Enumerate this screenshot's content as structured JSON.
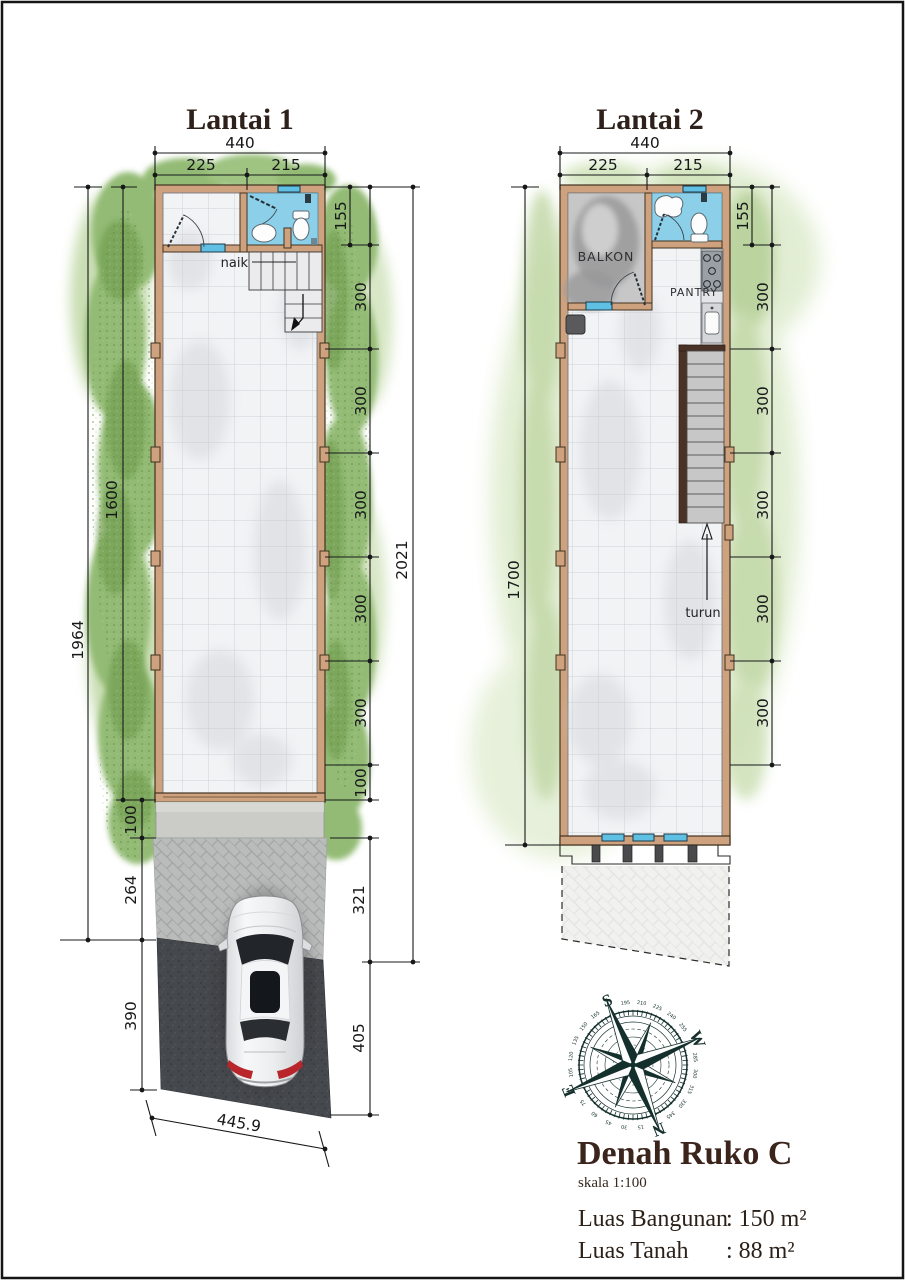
{
  "document": {
    "floor1": {
      "title": "Lantai 1",
      "dim_top_total": "440",
      "dim_top_left": "225",
      "dim_top_right": "215",
      "dim_left_outer": "1964",
      "dim_left_inner": "1600",
      "dim_left_chain": [
        "100",
        "264",
        "390"
      ],
      "dim_right_inner": "155",
      "dim_right_chain": [
        "300",
        "300",
        "300",
        "300",
        "300",
        "100"
      ],
      "dim_right_outer": "2021",
      "dim_right_lower": [
        "321",
        "405"
      ],
      "dim_bottom": "445.9",
      "stair_label": "naik"
    },
    "floor2": {
      "title": "Lantai 2",
      "dim_top_total": "440",
      "dim_top_left": "225",
      "dim_top_right": "215",
      "dim_left_outer": "1700",
      "dim_right_inner": "155",
      "dim_right_chain": [
        "300",
        "300",
        "300",
        "300",
        "300"
      ],
      "room_balcony": "BALKON",
      "room_pantry": "PANTRY",
      "stair_label": "turun"
    },
    "titleblock": {
      "title": "Denah Ruko C",
      "scale": "skala 1:100",
      "building_area_label": "Luas Bangunan",
      "building_area_value": ": 150 m²",
      "land_area_label": "Luas Tanah",
      "land_area_value": ": 88 m²"
    },
    "compass": {
      "north": "N",
      "east": "E",
      "south": "S",
      "west": "W",
      "rotation_deg": 158,
      "degrees": [
        "15",
        "30",
        "45",
        "60",
        "75",
        "105",
        "120",
        "135",
        "150",
        "165",
        "195",
        "210",
        "225",
        "240",
        "255",
        "285",
        "300",
        "315",
        "330",
        "345"
      ]
    },
    "colors": {
      "wall": "#cfa27f",
      "bathroom_floor": "#8ccfe8",
      "grass": "#93bb74",
      "window": "#5fc0e4",
      "asphalt": "#45484c"
    }
  }
}
